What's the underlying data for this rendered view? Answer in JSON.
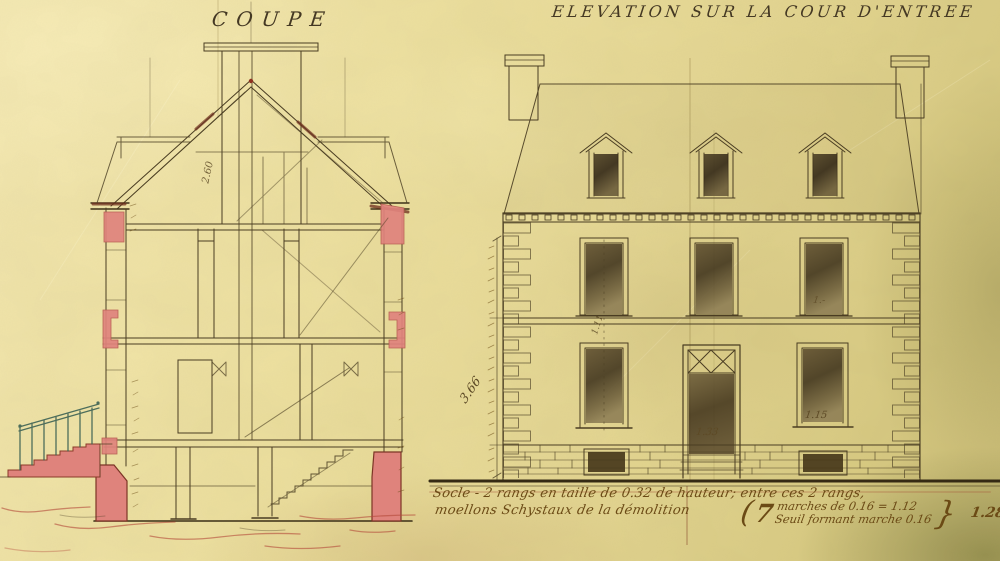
{
  "drawing": {
    "coupe": {
      "title": "COUPE",
      "labels": {
        "attic_height": "2.60"
      }
    },
    "elevation": {
      "title": "ELEVATION SUR LA COUR D'ENTREE",
      "labels": {
        "total_height": "3.66",
        "axis_mark": "1.11",
        "first_floor_window": "1.-",
        "door_width": "1.33",
        "ground_window_width": "1.15"
      }
    },
    "notes": {
      "socle_line1": "Socle - 2 rangs en taille de 0.32 de hauteur; entre ces 2 rangs,",
      "socle_line2": "moellons Schystaux de la démolition",
      "open_paren": "(",
      "steps_count": "7",
      "steps_calc": "marches de 0.16 = 1.12",
      "threshold_note": "Seuil formant marche 0.16",
      "close_brace": "}",
      "total_rise": "1.28"
    },
    "colors": {
      "paper": "#ece0a2",
      "ink": "#4a3d22",
      "masonry_pink": "#e0837d",
      "terrain_red": "#b44a3a",
      "railing_green": "#3c6154",
      "handwriting": "#6b4a15"
    }
  }
}
